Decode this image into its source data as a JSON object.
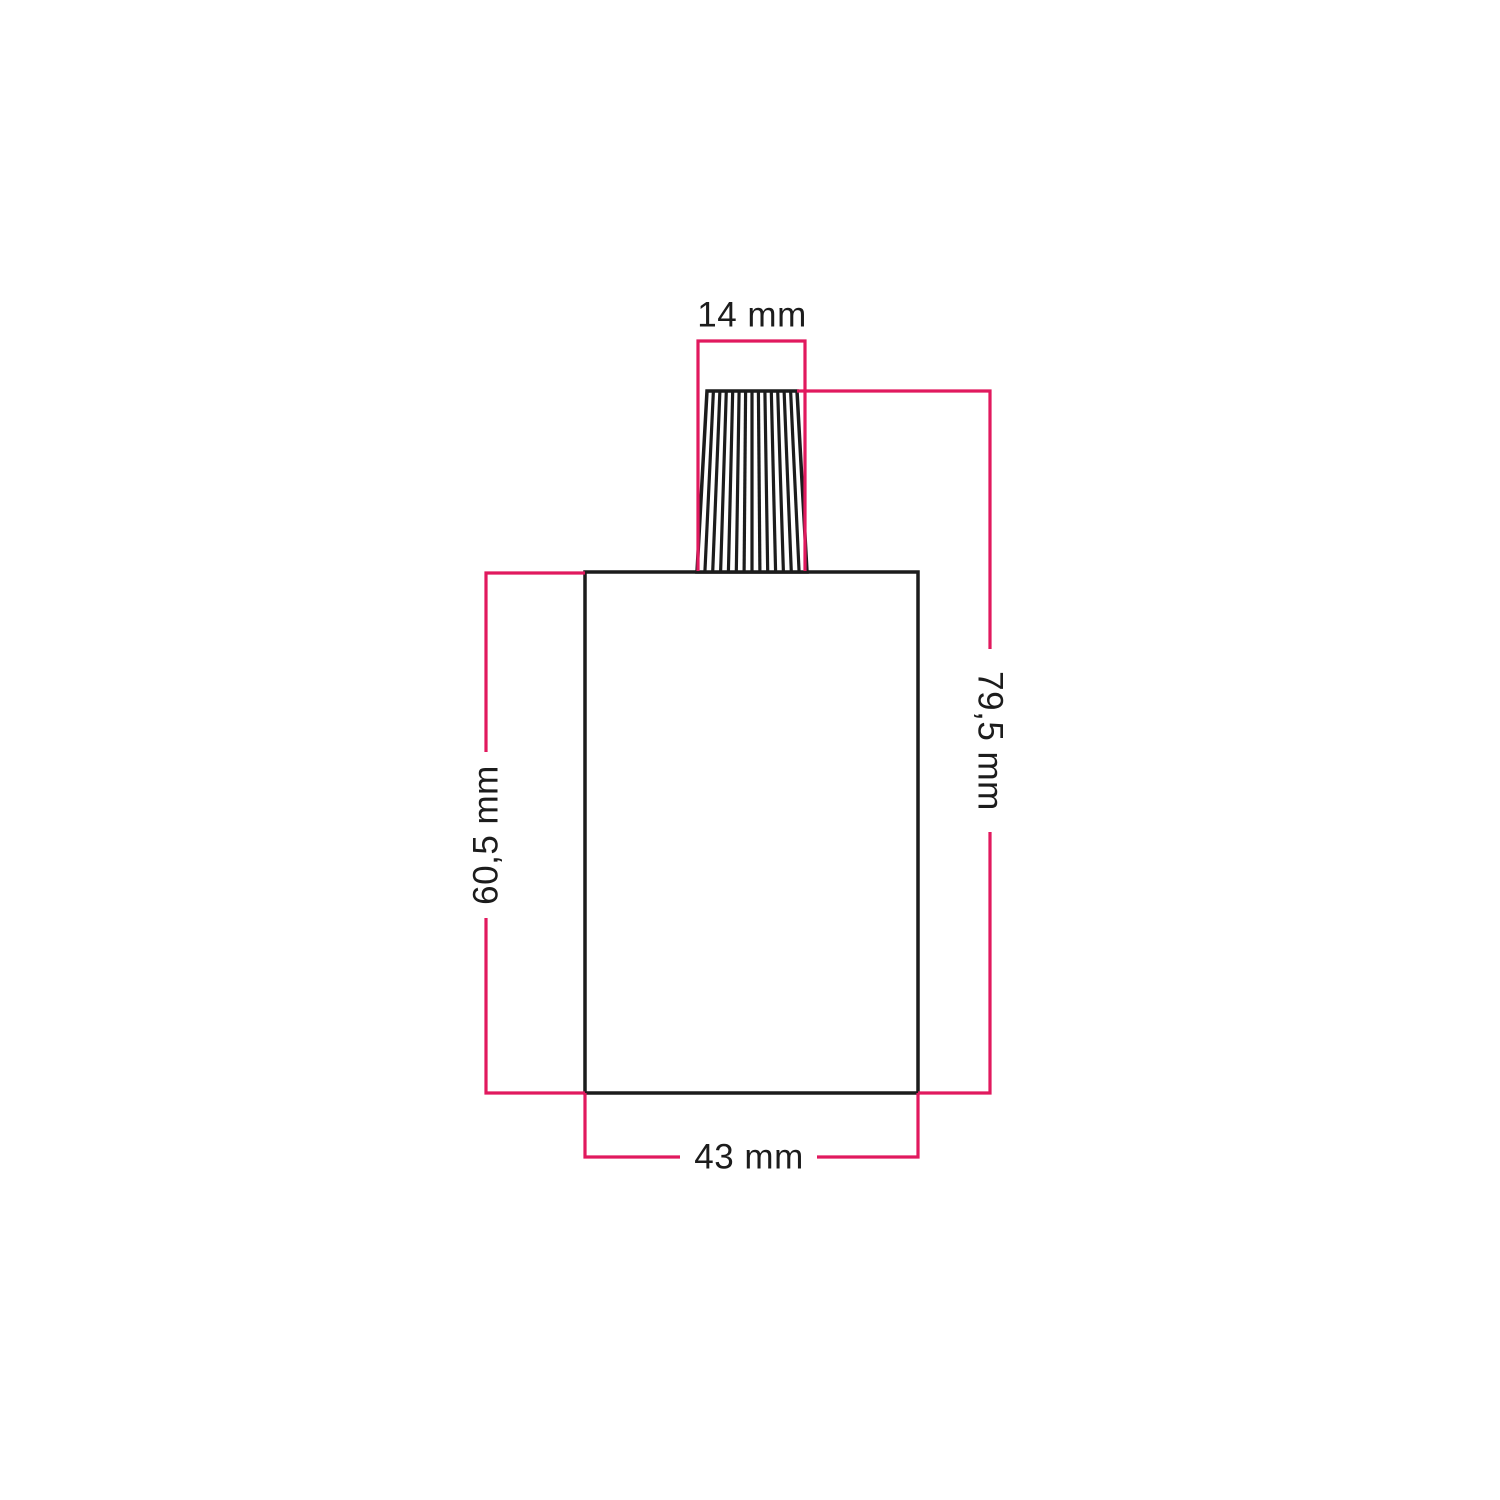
{
  "diagram": {
    "type": "technical-dimension-drawing",
    "subject": "lamp-holder-with-ribbed-cable-gland",
    "background": "#ffffff",
    "outline_color": "#1c1c1c",
    "dimension_color": "#e1195e",
    "fill_color": "#ffffff",
    "labels": {
      "gland_width": "14 mm",
      "total_height": "79,5 mm",
      "body_height": "60,5 mm",
      "body_width": "43 mm"
    }
  }
}
